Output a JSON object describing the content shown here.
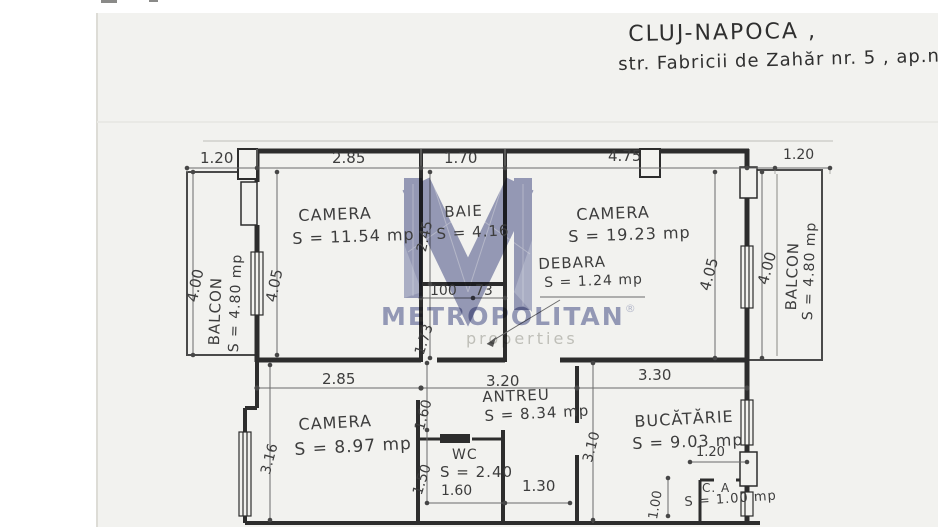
{
  "document": {
    "city_line": "CLUJ-NAPOCA ,",
    "address_line": "str. Fabricii de Zahăr nr. 5 , ap.nr."
  },
  "watermark": {
    "brand": "METROPOLITAN",
    "registered": "®",
    "subtitle": "properties",
    "logo_color": "#8e93b8",
    "text_color": "#9398bc"
  },
  "rooms": {
    "camera1": {
      "name": "CAMERA",
      "area": "S = 11.54 mp"
    },
    "baie": {
      "name": "BAIE",
      "area": "S = 4.16"
    },
    "camera2": {
      "name": "CAMERA",
      "area": "S = 19.23 mp"
    },
    "debara": {
      "name": "DEBARA",
      "area": "S = 1.24 mp"
    },
    "balcon_left": {
      "name": "BALCON",
      "area": "S = 4.80 mp"
    },
    "balcon_right": {
      "name": "BALCON",
      "area": "S = 4.80 mp"
    },
    "camera3": {
      "name": "CAMERA",
      "area": "S = 8.97 mp"
    },
    "antreu": {
      "name": "ANTREU",
      "area": "S = 8.34 mp"
    },
    "wc": {
      "name": "WC",
      "area": "S = 2.40"
    },
    "bucatarie": {
      "name": "BUCĂTĂRIE",
      "area": "S = 9.03 mp"
    },
    "camara": {
      "name": "C. A",
      "area": "S = 1.00 mp"
    }
  },
  "dims": {
    "d120l": "1.20",
    "d285t": "2.85",
    "d170": "1.70",
    "d475": "4.75",
    "d120r": "1.20",
    "d400l": "4.00",
    "d405l": "4.05",
    "d245": "2.45",
    "d173": "1.73",
    "d405r": "4.05",
    "d400r": "4.00",
    "d285m": "2.85",
    "d320": "3.20",
    "d330": "3.30",
    "d100": "100",
    "d73": "73",
    "d316": "3.16",
    "d160a": "1.60",
    "d150": "1.50",
    "d160wc": "1.60",
    "d130": "1.30",
    "d310": "3.10",
    "d120ca": "1.20",
    "d100ca": "1.00"
  }
}
